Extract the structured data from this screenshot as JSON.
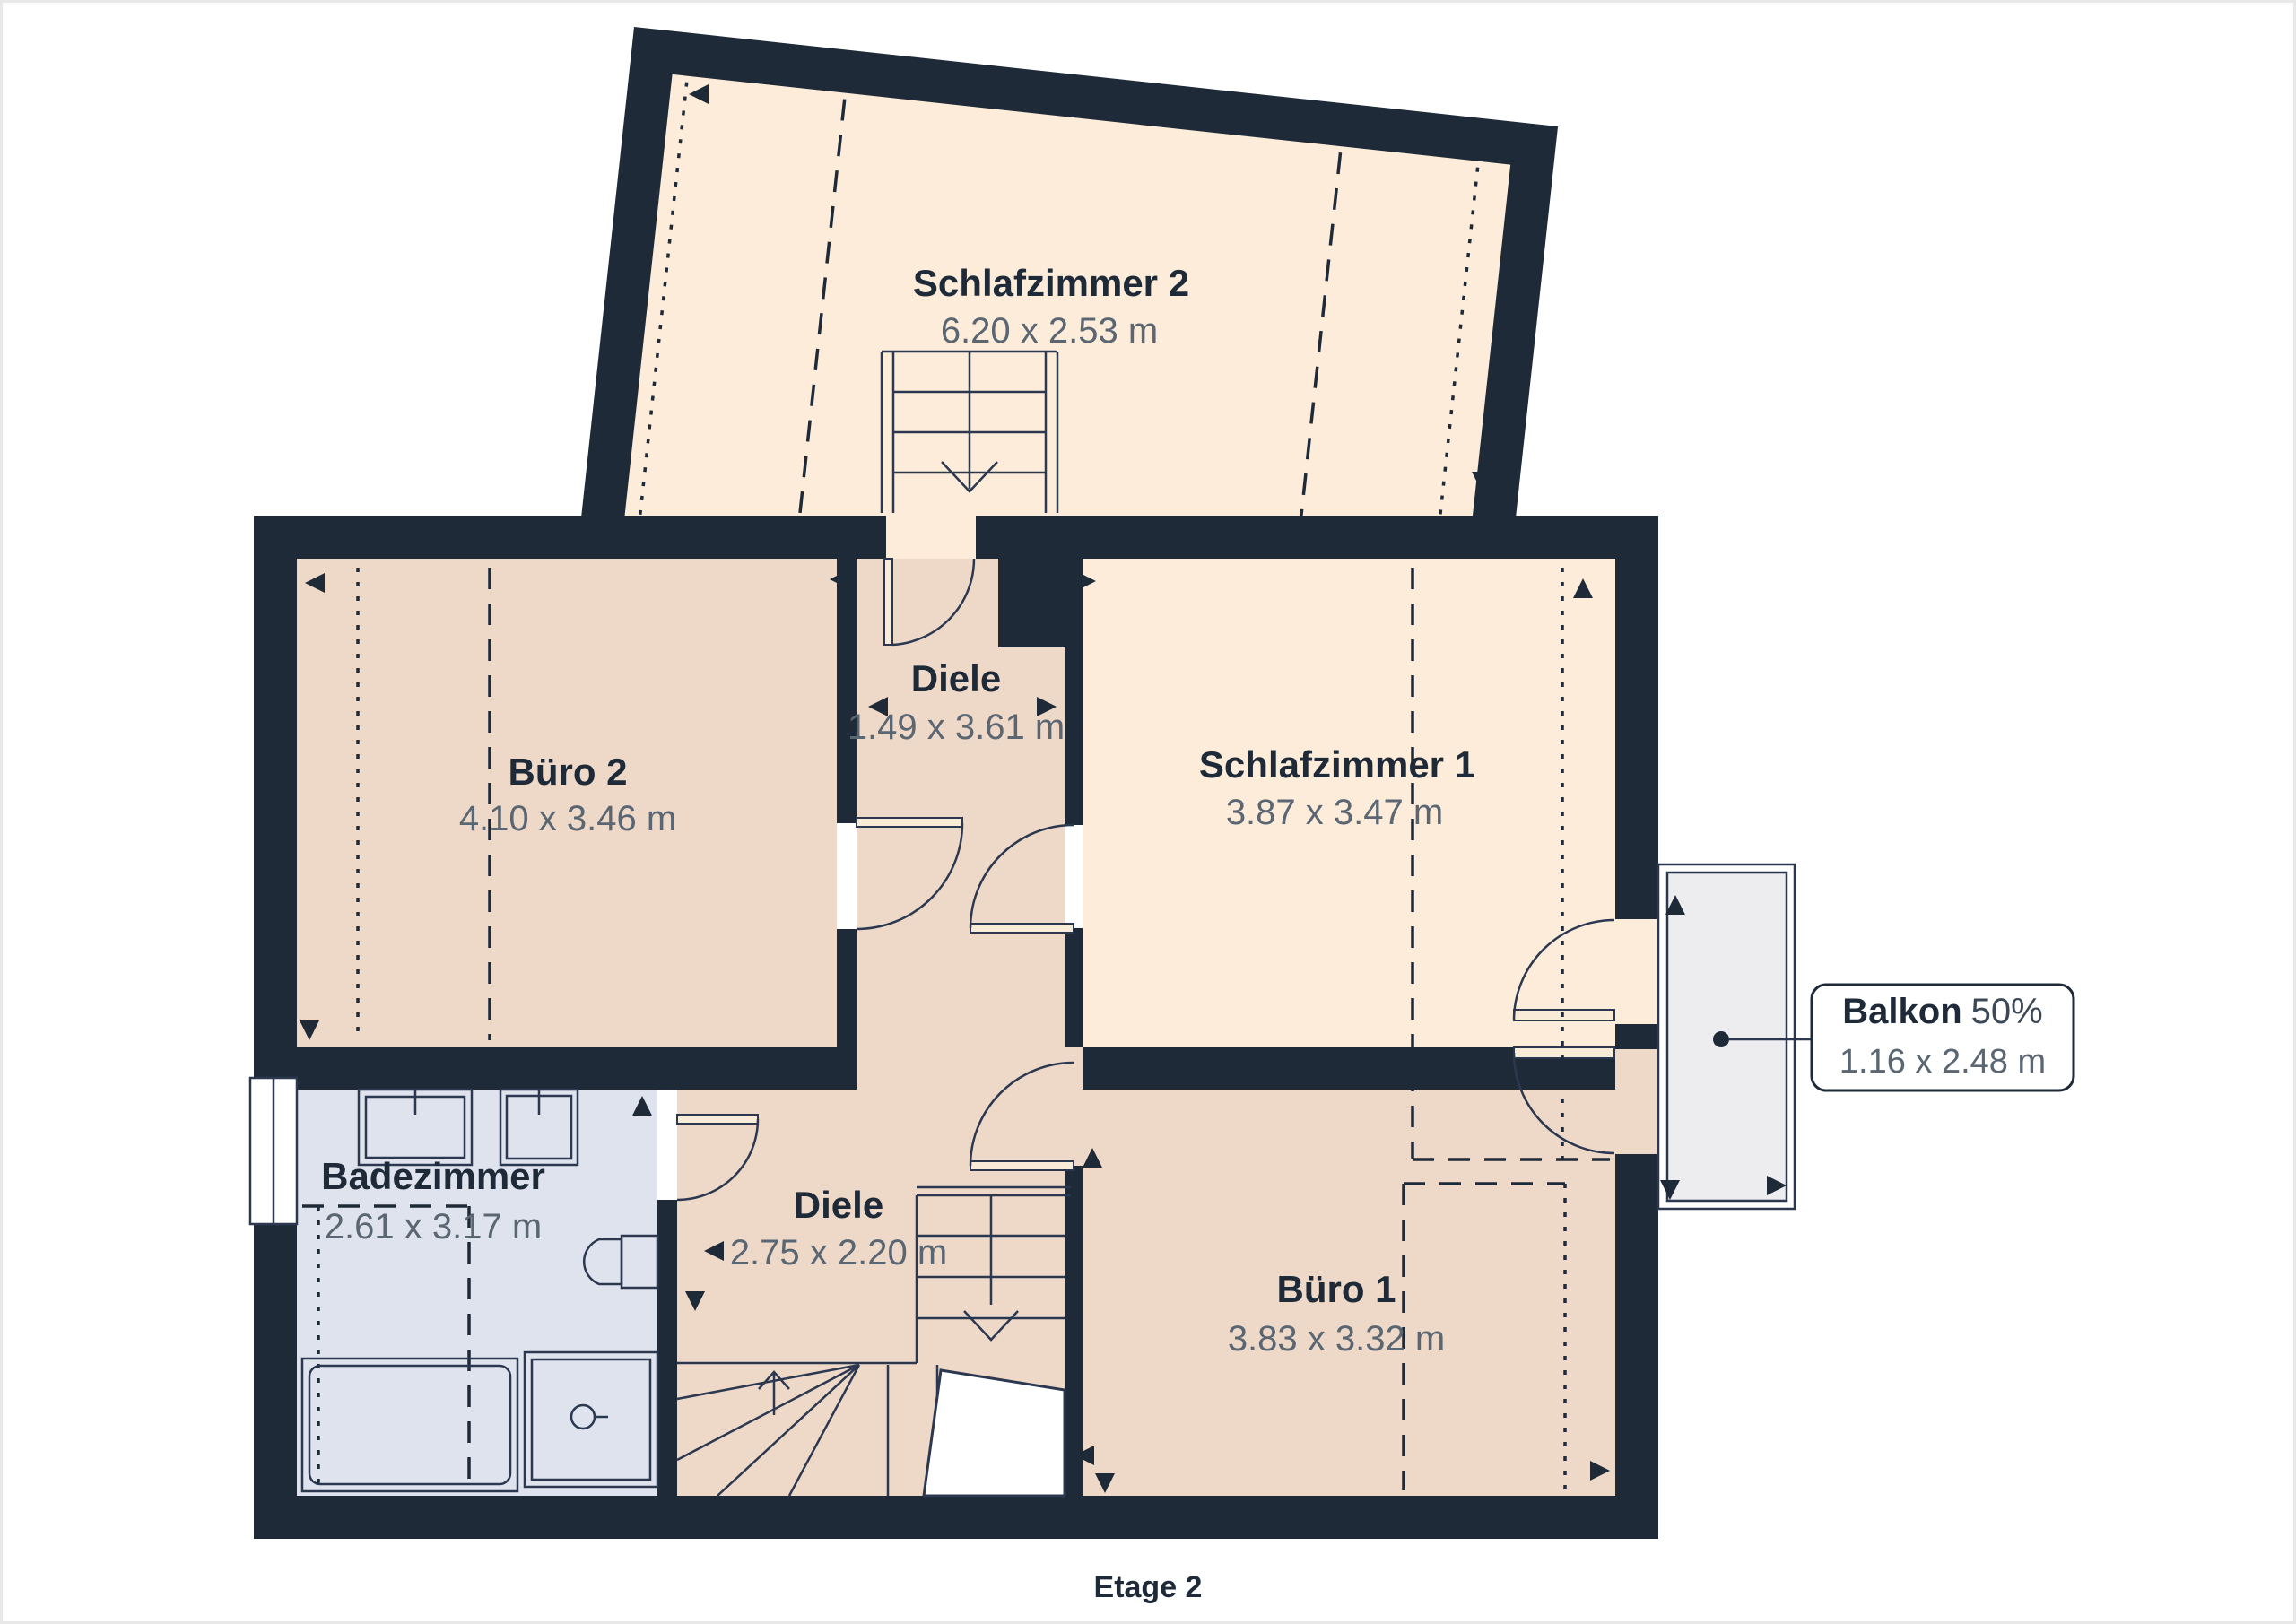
{
  "floor_plan": {
    "floor_label": "Etage 2",
    "rooms": [
      {
        "id": "schlafzimmer-2",
        "name": "Schlafzimmer 2",
        "dims": "6.20 x 2.53 m"
      },
      {
        "id": "buero-2",
        "name": "Büro 2",
        "dims": "4.10 x 3.46 m"
      },
      {
        "id": "diele-upper",
        "name": "Diele",
        "dims": "1.49 x 3.61 m"
      },
      {
        "id": "schlafzimmer-1",
        "name": "Schlafzimmer 1",
        "dims": "3.87 x 3.47 m"
      },
      {
        "id": "badezimmer",
        "name": "Badezimmer",
        "dims": "2.61 x 3.17 m"
      },
      {
        "id": "diele-lower",
        "name": "Diele",
        "dims": "2.75 x 2.20 m"
      },
      {
        "id": "buero-1",
        "name": "Büro 1",
        "dims": "3.83 x 3.32 m"
      }
    ],
    "balcony_callout": {
      "name": "Balkon",
      "share": "50%",
      "dims": "1.16 x 2.48 m"
    },
    "colors": {
      "wall": "#1e2a38",
      "bedroom": "#fcecd9",
      "office": "#eed8c7",
      "bathroom": "#dfe3ee",
      "balcony": "#ededf0",
      "background": "#ffffff",
      "border": "#e8e8e8",
      "label": "#1e2a38",
      "dims_text": "#5b6673"
    }
  }
}
